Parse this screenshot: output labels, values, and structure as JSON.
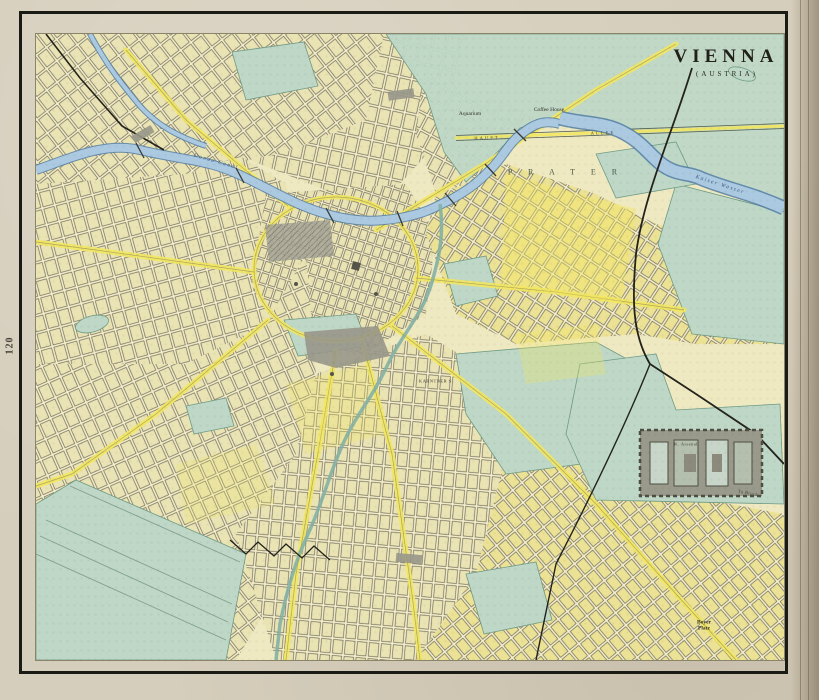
{
  "page": {
    "number": "120"
  },
  "map": {
    "title": "VIENNA",
    "subtitle": "(AUSTRIA)",
    "labels": {
      "aquarium": "Aquarium",
      "coffee_house": "Coffee House",
      "haupt": "HAUPT",
      "allee": "ALLEE",
      "prater": "P R A T E R",
      "kaiser_wasser": "Kaiser Wasser",
      "donau_canal": "Donau Canal",
      "karntner": "KARNTNER S.",
      "arsenal": "K. Arsenal",
      "to_bruck": "To Bruck",
      "boyer_platz": "Boyer\nPlatz"
    },
    "colors": {
      "paper": "#d6cebc",
      "map_bg": "#efe9c2",
      "street": "#f6f0cc",
      "block": "#eae3b4",
      "block_yellow": "#ece294",
      "grid_line": "#6e6a57",
      "water": "#abc9e0",
      "water_edge": "#527ea6",
      "park": "#bed7c6",
      "park_edge": "#6f9b85",
      "highlight_yellow": "#f2e75f",
      "ink": "#23221c",
      "building_gray": "#98978a"
    }
  }
}
